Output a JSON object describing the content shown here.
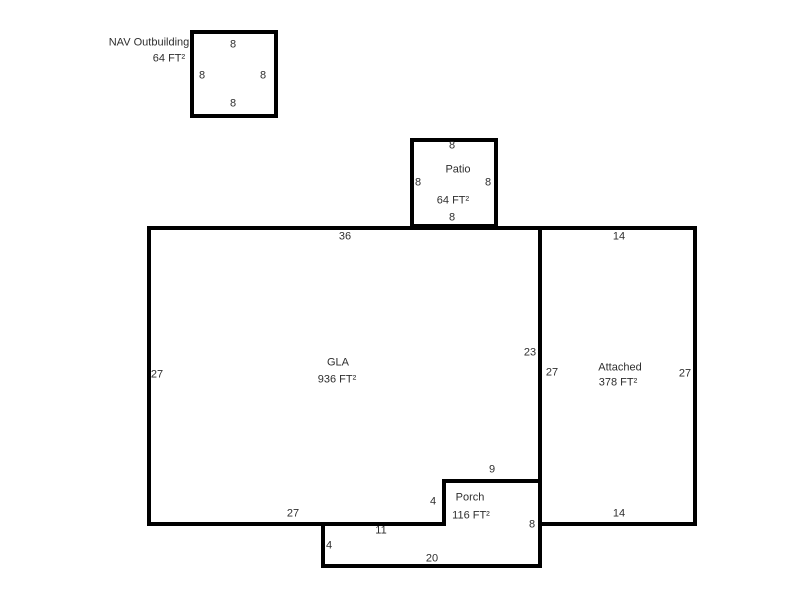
{
  "floorplan": {
    "outbuilding": {
      "name": "NAV Outbuilding",
      "area": "64 FT²",
      "dim_top": "8",
      "dim_left": "8",
      "dim_right": "8",
      "dim_bottom": "8"
    },
    "patio": {
      "name": "Patio",
      "area": "64 FT²",
      "dim_top": "8",
      "dim_left": "8",
      "dim_right": "8",
      "dim_bottom": "8"
    },
    "gla": {
      "name": "GLA",
      "area": "936 FT²",
      "dim_top": "36",
      "dim_left": "27",
      "dim_right": "23",
      "dim_bottom": "27"
    },
    "attached": {
      "name": "Attached",
      "area": "378 FT²",
      "dim_top": "14",
      "dim_left": "27",
      "dim_right": "27",
      "dim_bottom": "14"
    },
    "porch": {
      "name": "Porch",
      "area": "116 FT²",
      "dim_top": "9",
      "dim_upper_left": "4",
      "dim_right": "8",
      "dim_inner_top": "11",
      "dim_lower_left": "4",
      "dim_bottom": "20"
    }
  },
  "colors": {
    "wall": "#000000",
    "text": "#2e2e2e",
    "background": "#ffffff"
  }
}
